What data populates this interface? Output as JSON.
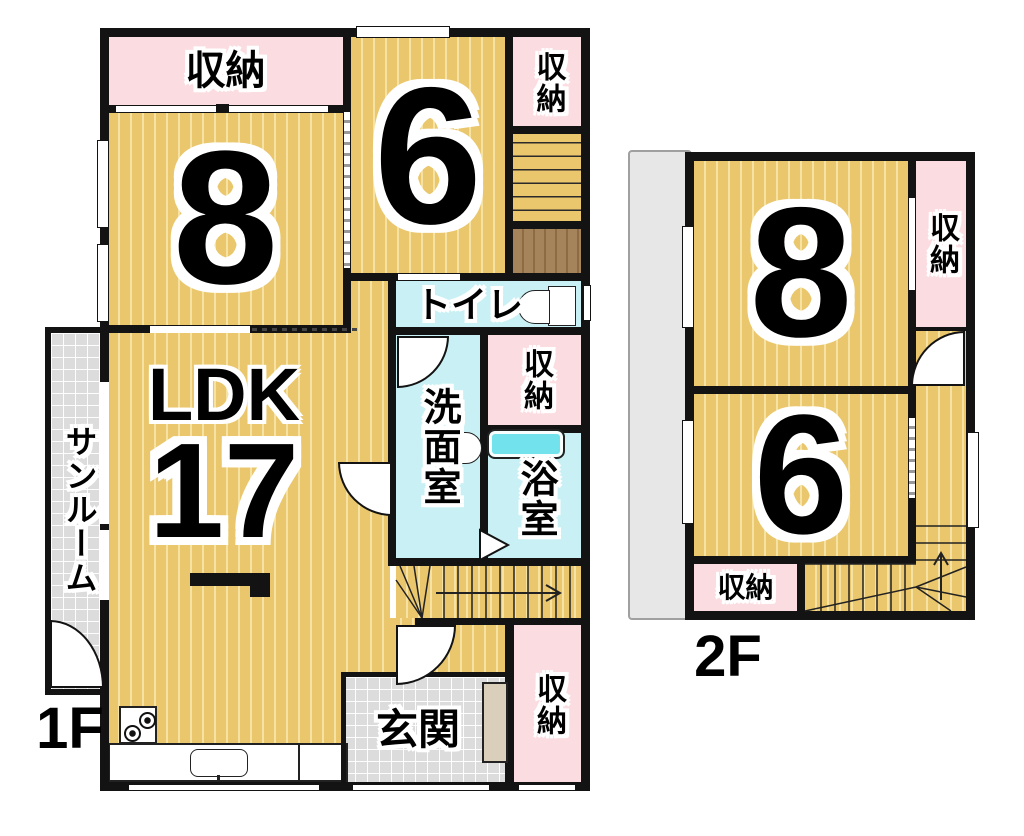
{
  "palette": {
    "wood_floor": "#eac76d",
    "wood_stripe": "#f6e3a4",
    "storage_pink": "#fbdce0",
    "wet_area_cyan": "#c9f1f5",
    "entrance_tile": "#dcdcdc",
    "closet_brown": "#a5835b",
    "bathtub_cyan": "#72e2ec",
    "wall_black": "#131313"
  },
  "floor1": {
    "label": "1F",
    "rooms": {
      "storage_top": "収納",
      "room8": "8",
      "room6": "6",
      "storage_topright": "収納",
      "toilet": "トイレ",
      "washroom": "洗面室",
      "storage_mid": "収納",
      "bath": "浴室",
      "ldk_label": "LDK",
      "ldk_size": "17",
      "sunroom": "サンルーム",
      "genkan": "玄関",
      "storage_bottomright": "収納"
    }
  },
  "floor2": {
    "label": "2F",
    "rooms": {
      "room8": "8",
      "room6": "6",
      "storage_right": "収納",
      "storage_bottom": "収納"
    }
  },
  "icons": {
    "toilet": "toilet-icon",
    "bathtub": "bathtub-icon",
    "stove": "stove-icon",
    "sink": "kitchen-sink-icon",
    "stairs_arrows": "stairs-direction-arrow"
  }
}
